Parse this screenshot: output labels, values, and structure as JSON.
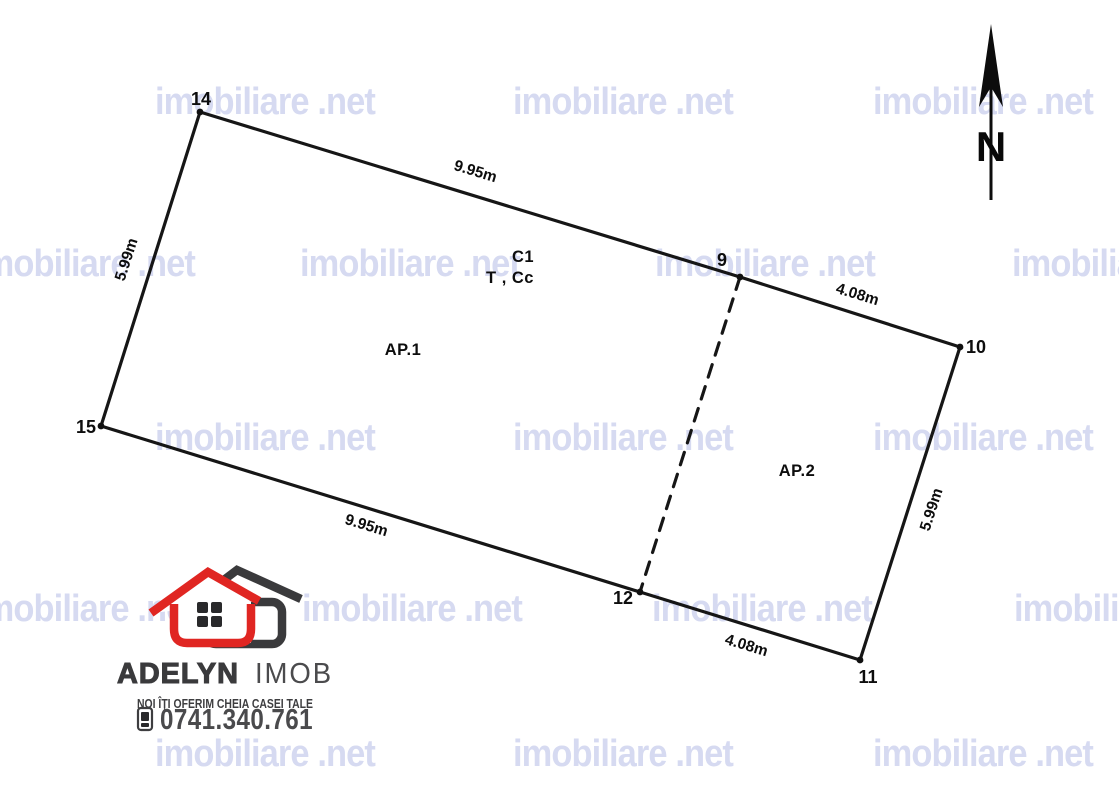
{
  "watermark": {
    "text": "imobiliare .net",
    "color": "#d6daf1",
    "rows": [
      {
        "y": 100,
        "xs": [
          155,
          513,
          873
        ]
      },
      {
        "y": 262,
        "xs": [
          -25,
          300,
          655,
          1012
        ]
      },
      {
        "y": 436,
        "xs": [
          155,
          513,
          873
        ]
      },
      {
        "y": 607,
        "xs": [
          -25,
          302,
          652,
          1014
        ]
      },
      {
        "y": 752,
        "xs": [
          155,
          513,
          873
        ]
      }
    ]
  },
  "plan": {
    "vertices": [
      {
        "id": "14",
        "x": 200,
        "y": 112,
        "label_x": 201,
        "label_y": 105
      },
      {
        "id": "9",
        "x": 740,
        "y": 277,
        "label_x": 722,
        "label_y": 266
      },
      {
        "id": "10",
        "x": 960,
        "y": 347,
        "label_x": 976,
        "label_y": 353
      },
      {
        "id": "11",
        "x": 860,
        "y": 660,
        "label_x": 868,
        "label_y": 683
      },
      {
        "id": "12",
        "x": 640,
        "y": 592,
        "label_x": 623,
        "label_y": 604
      },
      {
        "id": "15",
        "x": 101,
        "y": 426,
        "label_x": 86,
        "label_y": 433
      }
    ],
    "solid_edges": [
      [
        "14",
        "9"
      ],
      [
        "9",
        "10"
      ],
      [
        "10",
        "11"
      ],
      [
        "11",
        "12"
      ],
      [
        "12",
        "15"
      ],
      [
        "15",
        "14"
      ]
    ],
    "dashed_edges": [
      [
        "9",
        "12"
      ]
    ],
    "dimensions": [
      {
        "text": "9.95m",
        "x": 474,
        "y": 176,
        "angle": 17
      },
      {
        "text": "4.08m",
        "x": 856,
        "y": 299,
        "angle": 17
      },
      {
        "text": "5.99m",
        "x": 936,
        "y": 511,
        "angle": -72
      },
      {
        "text": "9.95m",
        "x": 365,
        "y": 530,
        "angle": 17
      },
      {
        "text": "4.08m",
        "x": 745,
        "y": 650,
        "angle": 17
      },
      {
        "text": "5.99m",
        "x": 131,
        "y": 261,
        "angle": -72
      }
    ],
    "area_labels": [
      {
        "text": "C1",
        "x": 523,
        "y": 262
      },
      {
        "text": "T , Cc",
        "x": 510,
        "y": 283
      },
      {
        "text": "AP.1",
        "x": 403,
        "y": 355
      },
      {
        "text": "AP.2",
        "x": 797,
        "y": 476
      }
    ]
  },
  "north": {
    "label": "N"
  },
  "logo": {
    "name_primary": "ADELYN",
    "name_secondary": "IMOB",
    "tagline": "NOI ÎȚI OFERIM CHEIA CASEI TALE",
    "phone": "0741.340.761",
    "red": "#e02622",
    "dark": "#3a3a3c"
  }
}
